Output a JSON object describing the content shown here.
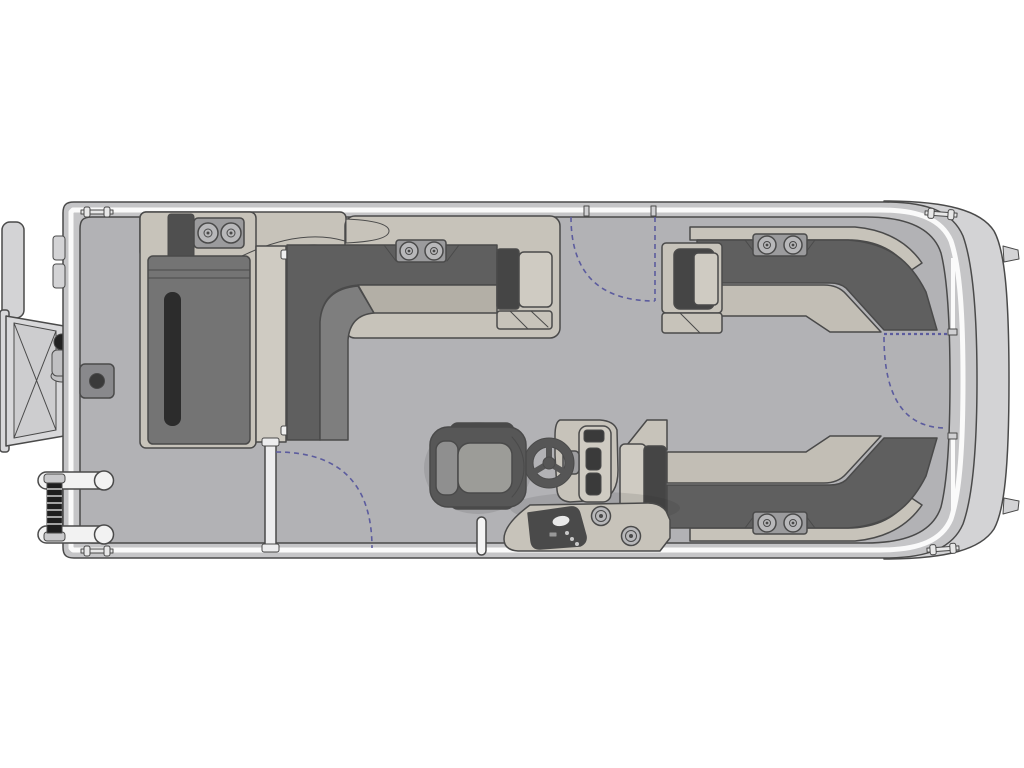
{
  "page": {
    "description": "Top-down floor plan diagram of a pontoon boat",
    "background": "#ffffff"
  },
  "colors": {
    "background": "#ffffff",
    "outline": "#4a4a4a",
    "hull_rim": "#c5c5c7",
    "nose_cap": "#d3d3d5",
    "deck": "#b2b2b5",
    "rail_white": "#fafafa",
    "upholstery_tan": "#c7c3ba",
    "upholstery_pad": "#cfcbc2",
    "cushion_dark": "#5f5f5f",
    "cushion_mid": "#7e7e7e",
    "cushion_light": "#c2beb5",
    "cushion_greige": "#b3afa6",
    "lounge_cushion": "#747474",
    "accent_black": "#2c2c2c",
    "panel_dark": "#454545",
    "console_slot": "#3a3a3a",
    "hardware_gray": "#9b9b9d",
    "hardware_ring": "#b8b8ba",
    "hardware_light": "#ededee",
    "chair_shell": "#575757",
    "chair_arm": "#4a4a4a",
    "chair_back": "#8f8f8f",
    "chair_seat": "#9c9c98",
    "platform_gray": "#d8d8da",
    "gate_swing": "#5c5c9e"
  },
  "components": {
    "hull": "pontoon hull with rounded bow nose",
    "rub_rail": "white perimeter fence rail",
    "deck": "main deck floor",
    "stern_swim_platform": "fold-down boarding platform and motor bracket at stern",
    "stern_boarding_ladder": "two-rung boarding ladder, aft port corner",
    "fuel_cap": "fuel filler cap on stern deck",
    "stern_lounge": "aft chaise lounge with cup holders",
    "walkthrough_panel": "aft walk-through filler panel",
    "port_bench": "port-side L-shaped lounge with armrest and cup holders",
    "bow_port_bench": "bow port L-shaped lounge with armrest and cup holders",
    "bow_starboard_bench": "bow starboard L-shaped lounge with armrest and cup holders",
    "helm_console": "helm console with gauge vents",
    "steering_wheel": "three-spoke steering wheel",
    "captains_chair": "captain's swivel chair with armrests",
    "lower_console": "lower helm console with throttle panel and cup holders",
    "grab_post": "deck grab post",
    "gates": "three boarding gates with swing arcs (port, starboard, bow)",
    "cleats": "mooring cleats at four corners"
  }
}
